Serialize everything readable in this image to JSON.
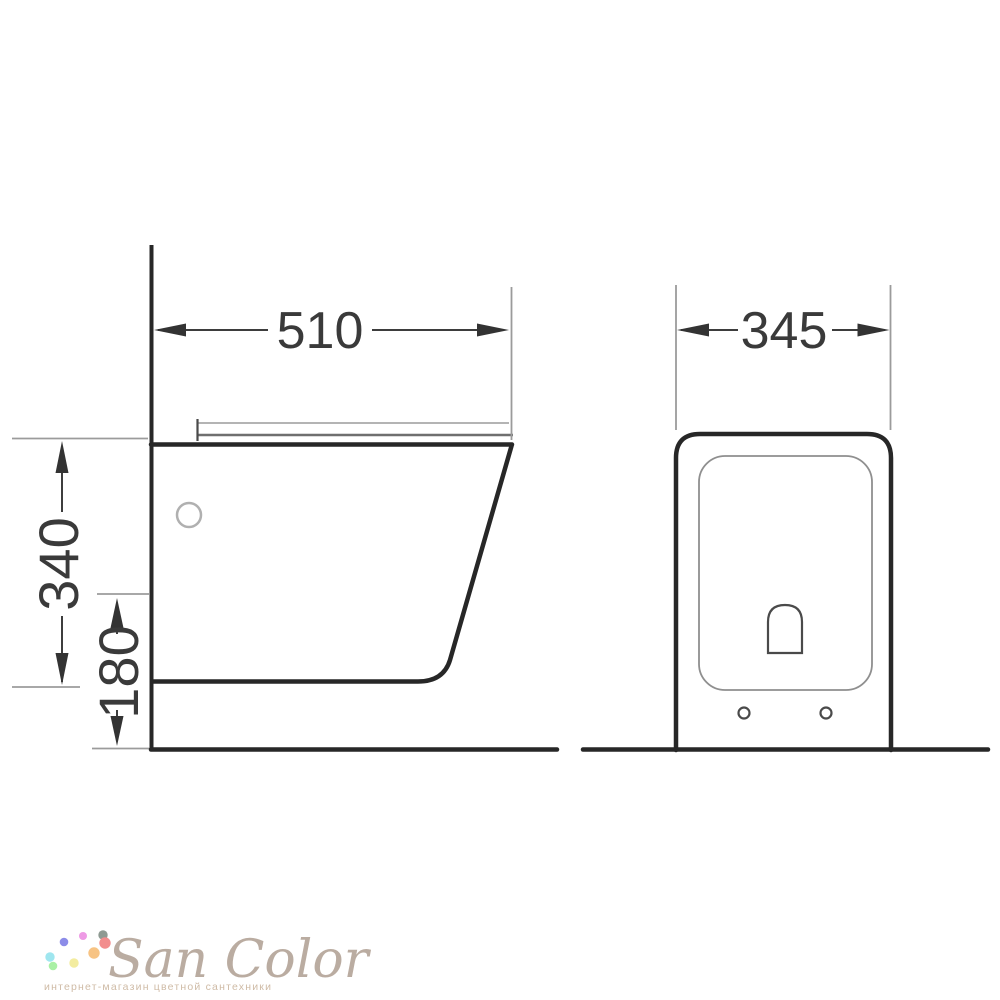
{
  "dimensions": {
    "side_view": {
      "width_mm": "510",
      "height_total_mm": "340",
      "floor_clearance_mm": "180"
    },
    "front_view": {
      "width_mm": "345"
    }
  },
  "colors": {
    "outline": "#272727",
    "dimension_text": "#3a3a3a",
    "extension_line": "#9b9b9b"
  },
  "watermark": {
    "brand": "San Color",
    "tagline": "интернет-магазин цветной сантехники",
    "brand_color": "#b5a69a",
    "tagline_color": "#cfbba6",
    "dots": [
      {
        "name": "periwinkle-dot",
        "color": "#8c8ce8"
      },
      {
        "name": "orchid-dot",
        "color": "#ee9ae5"
      },
      {
        "name": "gray-green-dot",
        "color": "#8e9a92"
      },
      {
        "name": "salmon-dot",
        "color": "#f28d8d"
      },
      {
        "name": "cyan-dot",
        "color": "#9fe6ef"
      },
      {
        "name": "orange-dot",
        "color": "#f7c383"
      },
      {
        "name": "green-dot",
        "color": "#a9f0a5"
      },
      {
        "name": "yellow-dot",
        "color": "#f3ec9f"
      }
    ]
  }
}
